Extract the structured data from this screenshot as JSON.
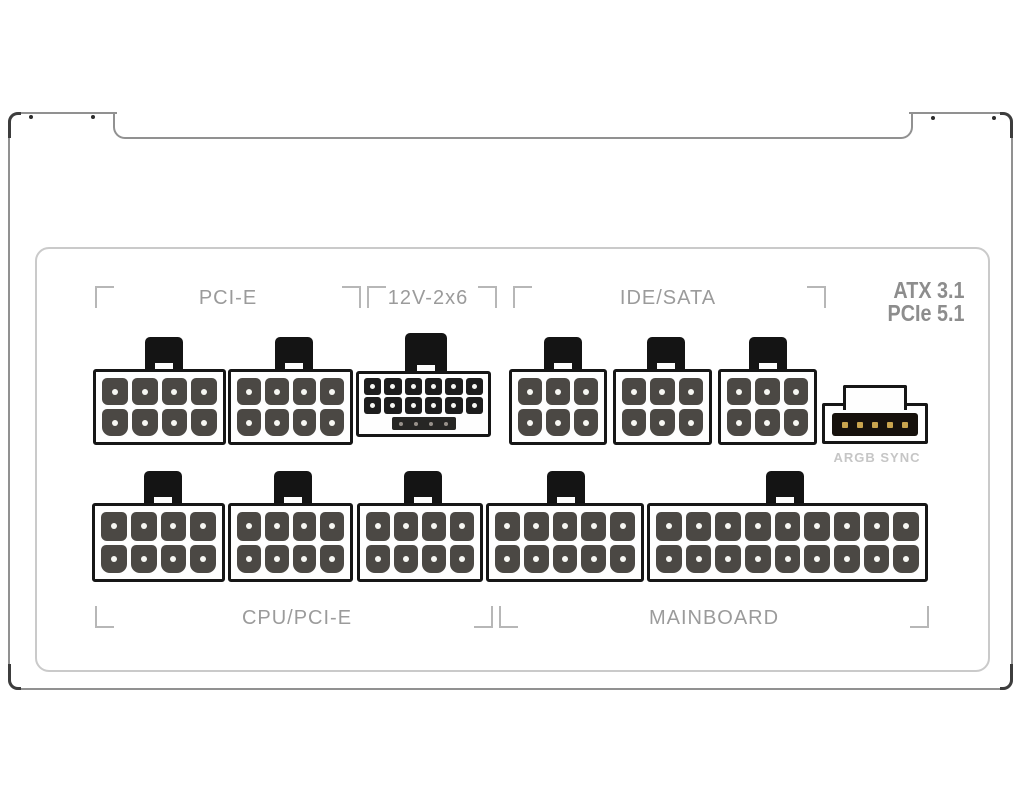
{
  "labels": {
    "pcie": "PCI-E",
    "twelve_v_2x6": "12V-2x6",
    "ide_sata": "IDE/SATA",
    "argb_sync": "ARGB SYNC",
    "cpu_pcie": "CPU/PCI-E",
    "mainboard": "MAINBOARD",
    "standard_line1": "ATX 3.1",
    "standard_line2": "PCIe 5.1"
  },
  "colors": {
    "label_gray": "#9b9b9b",
    "standards_gray": "#8d8d8d",
    "argb_label_gray": "#c6c6c6",
    "mark_gray": "#b7b7b7",
    "body_outline": "#919191",
    "tick_dark": "#3d3d3d",
    "panel_outline": "#cacaca",
    "connector_outline": "#161616",
    "pin_fill": "#4b4844",
    "pin_dot": "#f6f6f2",
    "argb_pin_gold": "#c9a44e"
  },
  "connectors": [
    {
      "id": "pcie-1",
      "group": "PCI-E",
      "type": "std",
      "x": 93,
      "y": 369,
      "w": 133,
      "h": 76,
      "cols": 4,
      "clip_cx": 164
    },
    {
      "id": "pcie-2",
      "group": "PCI-E",
      "type": "std",
      "x": 228,
      "y": 369,
      "w": 125,
      "h": 76,
      "cols": 4,
      "clip_cx": 294
    },
    {
      "id": "12v-2x6",
      "group": "12V-2x6",
      "type": "12v",
      "x": 356,
      "y": 371,
      "w": 135,
      "h": 66,
      "cols": 6,
      "clip_cx": 426
    },
    {
      "id": "ide-sata-1",
      "group": "IDE/SATA",
      "type": "std",
      "x": 509,
      "y": 369,
      "w": 98,
      "h": 76,
      "cols": 3,
      "clip_cx": 563
    },
    {
      "id": "ide-sata-2",
      "group": "IDE/SATA",
      "type": "std",
      "x": 613,
      "y": 369,
      "w": 99,
      "h": 76,
      "cols": 3,
      "clip_cx": 666
    },
    {
      "id": "ide-sata-3",
      "group": "IDE/SATA",
      "type": "std",
      "x": 718,
      "y": 369,
      "w": 99,
      "h": 76,
      "cols": 3,
      "clip_cx": 768
    },
    {
      "id": "argb-sync",
      "group": "ARGB SYNC",
      "type": "argb",
      "x": 822,
      "y": 403,
      "w": 106,
      "h": 41,
      "pins": 5
    },
    {
      "id": "cpu-1",
      "group": "CPU/PCI-E",
      "type": "std",
      "x": 92,
      "y": 503,
      "w": 133,
      "h": 79,
      "cols": 4,
      "clip_cx": 163
    },
    {
      "id": "cpu-2",
      "group": "CPU/PCI-E",
      "type": "std",
      "x": 228,
      "y": 503,
      "w": 125,
      "h": 79,
      "cols": 4,
      "clip_cx": 293
    },
    {
      "id": "cpu-3",
      "group": "CPU/PCI-E",
      "type": "std",
      "x": 357,
      "y": 503,
      "w": 126,
      "h": 79,
      "cols": 4,
      "clip_cx": 423
    },
    {
      "id": "mainboard-1",
      "group": "MAINBOARD",
      "type": "std",
      "x": 486,
      "y": 503,
      "w": 158,
      "h": 79,
      "cols": 5,
      "clip_cx": 566
    },
    {
      "id": "mainboard-2",
      "group": "MAINBOARD",
      "type": "std",
      "x": 647,
      "y": 503,
      "w": 281,
      "h": 79,
      "cols": 9,
      "clip_cx": 785
    }
  ]
}
